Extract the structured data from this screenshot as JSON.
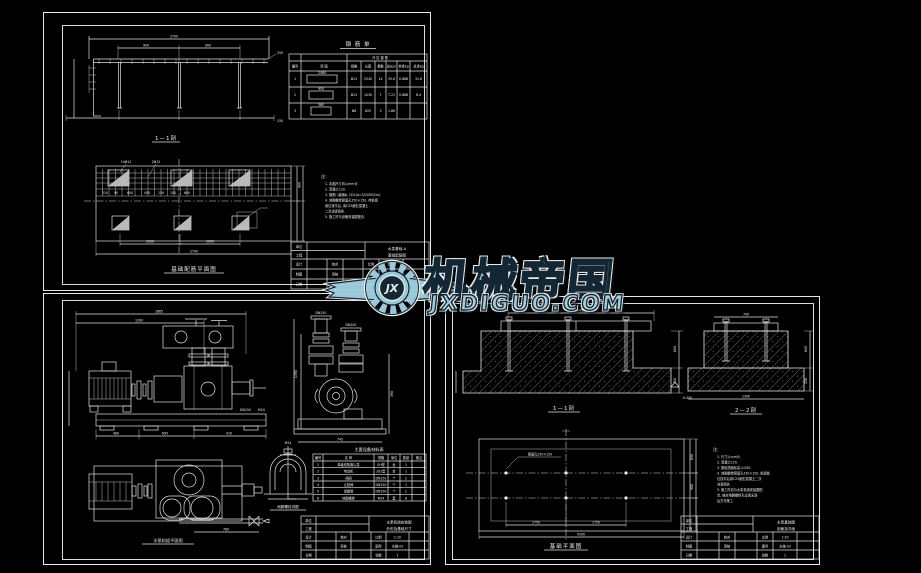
{
  "watermark": {
    "brand": "机械帝国",
    "domain": "JXDIGUO.COM",
    "monogram": "JX",
    "colors": {
      "fill": "#a9d2e0",
      "outline": "#142835",
      "halo": "#f2f2f2"
    }
  },
  "sheet1": {
    "rebar_table": {
      "title": "钢 筋 单",
      "band_header": "冷 拉 钢 筋",
      "col_headers": [
        "编号",
        "简 图",
        "规格",
        "长度",
        "根数",
        "总长m",
        "单重kg",
        "总重kg"
      ],
      "rows": [
        [
          "1",
          "2460",
          "Φ12",
          "2540",
          "14",
          "35.6",
          "0.888",
          "31.6"
        ],
        [
          "2",
          "950",
          "Φ12",
          "1030",
          "7",
          "7.21",
          "0.888",
          "6.4"
        ],
        [
          "3",
          "560",
          "Φ8",
          "620",
          "3",
          "1.86",
          "0.395",
          "0.73"
        ]
      ]
    },
    "elevation": {
      "caption": "1—1剖",
      "dims": [
        "2700",
        "900",
        "900",
        "250",
        "150"
      ]
    },
    "plan": {
      "caption": "基础配筋平面图",
      "labels": [
        "14Φ12",
        "2Φ12"
      ],
      "dims": [
        "210",
        "90",
        "600",
        "450",
        "150",
        "150",
        "600",
        "1200",
        "1200",
        "2700"
      ],
      "side_dims": [
        "900"
      ]
    },
    "notes": {
      "title": "注:",
      "lines": [
        "1. 本图尺寸均以mm计.",
        "2. 混凝土C20.",
        "3. 钢筋: I级钢φ, CD2(d=5/2000/2m).",
        "4. 地脚螺栓预留孔150×150, 待机组",
        "   就位找平后, 用C25细石混凝土",
        "   二次浇灌捣实.",
        "5. 施工时与设备安装图配合."
      ]
    },
    "title_block": {
      "label_unit": "单位",
      "label_project": "工程",
      "title_line1": "水泵基础-A",
      "title_line2": "基础配筋图",
      "r1": [
        "设计",
        "校对",
        "比例"
      ],
      "r2": [
        "制图",
        "审核",
        "图号"
      ],
      "r3": [
        "日期",
        "",
        "张数"
      ],
      "scale": "1:20",
      "no": "水施-01",
      "sheets": "1"
    }
  },
  "sheet2": {
    "side_view": {
      "dims": [
        "1865",
        "1200",
        "480",
        "695",
        "410"
      ],
      "labels": [
        "DN150",
        "M24"
      ]
    },
    "end_view": {
      "dims": [
        "1390",
        "745",
        "390"
      ],
      "labels": [
        "DN150",
        "DN100"
      ]
    },
    "top_view": {
      "caption": "水泵机组平面图",
      "dims": [
        "760"
      ]
    },
    "detail": {
      "caption": "地脚螺栓详图",
      "label": "M24"
    },
    "equip_table": {
      "title": "主要设备材料表",
      "col_headers": [
        "编号",
        "名 称",
        "规格",
        "单位",
        "数量",
        "备注"
      ],
      "rows": [
        [
          "1",
          "单级双吸离心泵",
          "SH型",
          "台",
          "1"
        ],
        [
          "2",
          "电动机",
          "JO2型",
          "台",
          "1"
        ],
        [
          "3",
          "闸阀",
          "DN150",
          "个",
          "2"
        ],
        [
          "4",
          "止回阀",
          "DN150",
          "个",
          "1"
        ],
        [
          "5",
          "渐缩管",
          "DN150",
          "个",
          "2"
        ],
        [
          "6",
          "地脚螺栓",
          "M24",
          "套",
          "6"
        ]
      ]
    },
    "title_block": {
      "label_unit": "单位",
      "label_project": "工程",
      "title_line1": "水泵机组安装图",
      "title_line2": "外形及基础尺寸",
      "r1": [
        "设计",
        "校对",
        "比例"
      ],
      "r2": [
        "制图",
        "审核",
        "图号"
      ],
      "r3": [
        "日期",
        "",
        "张数"
      ],
      "scale": "1:10",
      "no": "水施-02",
      "sheets": "1"
    }
  },
  "sheet3": {
    "section1": {
      "caption": "1—1剖",
      "dims": [
        "1450",
        "600",
        "250"
      ],
      "level": "-0.050"
    },
    "section2": {
      "caption": "2—2剖",
      "dims": [
        "700",
        "600",
        "250",
        "1300"
      ]
    },
    "plan": {
      "caption": "基础平面图",
      "leader": "预留孔150×150",
      "dims": [
        "1750",
        "1750",
        "4100"
      ],
      "side_dims": [
        "650",
        "900"
      ]
    },
    "notes": {
      "title": "注:",
      "lines": [
        "1. 尺寸以mm计.",
        "2. 混凝土C20.",
        "3. 基础顶面标高-0.050.",
        "4. 地脚螺栓预留孔150×150, 机组就",
        "   位找平后用C25细石混凝土二次",
        "   浇灌捣实.",
        "5. 施工时应与水泵机组安装图配",
        "   合, 核对地脚螺栓孔位置无误",
        "   后方可施工."
      ]
    },
    "title_block": {
      "label_unit": "单位",
      "label_project": "工程",
      "title_line1": "水泵基础图",
      "title_line2": "剖面及平面",
      "r1": [
        "设计",
        "校对",
        "比例"
      ],
      "r2": [
        "制图",
        "审核",
        "图号"
      ],
      "r3": [
        "日期",
        "",
        "张数"
      ],
      "scale": "1:20",
      "no": "水施-03",
      "sheets": "1"
    }
  }
}
